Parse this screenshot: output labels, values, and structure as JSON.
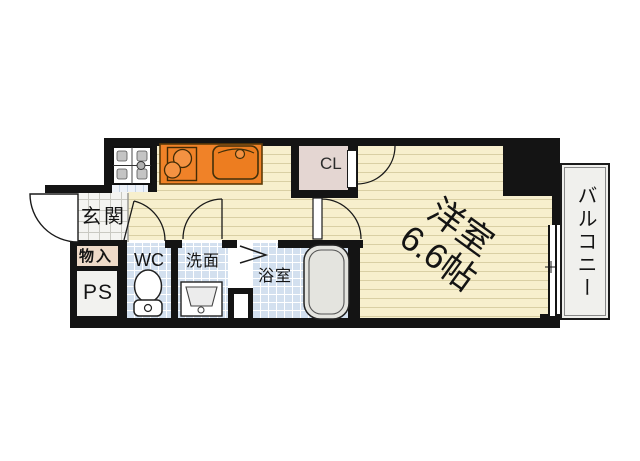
{
  "rooms": {
    "entrance": "玄関",
    "storage": "物入",
    "pipe_space": "PS",
    "toilet": "WC",
    "washroom": "洗面",
    "bathroom": "浴室",
    "closet": "CL",
    "main_room_line1": "洋室",
    "main_room_line2": "6.6帖",
    "balcony": "バルコニー"
  },
  "icons": {
    "washing_machine": "washing-machine-icon",
    "gas_stove": "gas-stove-icon",
    "kitchen_sink": "kitchen-sink-icon",
    "toilet": "toilet-icon",
    "vanity_sink": "vanity-sink-icon",
    "bathtub": "bathtub-icon",
    "entrance_door": "entrance-door-swing-icon",
    "folding_door": "folding-door-icon",
    "window": "sliding-window-icon"
  },
  "colors": {
    "wall": "#141414",
    "wood_floor": "#f7efcd",
    "wet_tile": "#d3e0ef",
    "kitchen_counter": "#f08228",
    "closet_fill": "#e4d6d2",
    "storage_fill": "#eedac8",
    "bathtub_fill": "#e4e4df",
    "balcony_fill": "#f0f0ed"
  }
}
